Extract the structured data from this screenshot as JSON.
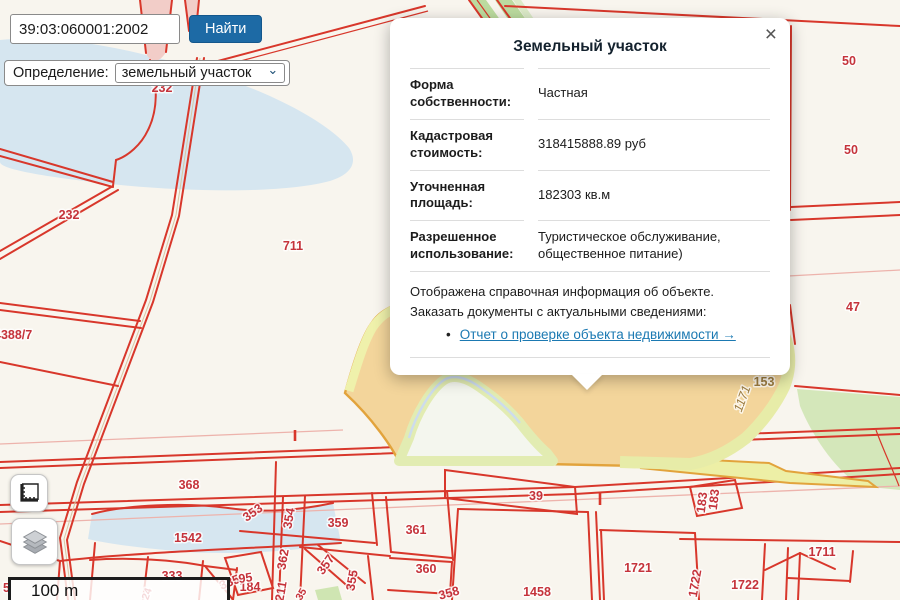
{
  "search": {
    "value": "39:03:060001:2002",
    "button_label": "Найти"
  },
  "filter": {
    "label": "Определение:",
    "selected": "земельный участок",
    "chevron": "⌄"
  },
  "popup": {
    "title": "Земельный участок",
    "close_label": "×",
    "bullet": "•",
    "rows": [
      {
        "label": "Форма собственности:",
        "value": "Частная"
      },
      {
        "label": "Кадастровая стоимость:",
        "value": "318415888.89 руб"
      },
      {
        "label": "Уточненная площадь:",
        "value": "182303 кв.м"
      },
      {
        "label": "Разрешенное использование:",
        "value": "Туристическое обслуживание, общественное питание)"
      }
    ],
    "note_line1": "Отображена справочная информация об объекте.",
    "note_line2": "Заказать документы с актуальными сведениями:",
    "link_label": "Отчет о проверке объекта недвижимости →"
  },
  "map": {
    "scale_label": "100 m",
    "labels": [
      {
        "text": "232",
        "x": 162,
        "y": 92
      },
      {
        "text": "232",
        "x": 69,
        "y": 219
      },
      {
        "text": "711",
        "x": 293,
        "y": 250
      },
      {
        "text": "4388/7",
        "x": -6,
        "y": 339,
        "cls": "start"
      },
      {
        "text": "50",
        "x": 849,
        "y": 65
      },
      {
        "text": "50",
        "x": 851,
        "y": 154
      },
      {
        "text": "47",
        "x": 853,
        "y": 311
      },
      {
        "text": "153",
        "x": 452,
        "y": 321,
        "cls": "brown"
      },
      {
        "text": "1171",
        "x": 540,
        "y": 328,
        "cls": "brown-italic"
      },
      {
        "text": "1171",
        "x": 746,
        "y": 400,
        "rot": -70,
        "cls": "brown-italic"
      },
      {
        "text": "153",
        "x": 764,
        "y": 386,
        "cls": "brown"
      },
      {
        "text": "368",
        "x": 189,
        "y": 489
      },
      {
        "text": "39",
        "x": 536,
        "y": 500
      },
      {
        "text": "1542",
        "x": 188,
        "y": 542
      },
      {
        "text": "353",
        "x": 255,
        "y": 516,
        "rot": -35
      },
      {
        "text": "354",
        "x": 293,
        "y": 519,
        "rot": -80
      },
      {
        "text": "359",
        "x": 338,
        "y": 527
      },
      {
        "text": "361",
        "x": 416,
        "y": 534
      },
      {
        "text": "360",
        "x": 426,
        "y": 573
      },
      {
        "text": "333",
        "x": 172,
        "y": 580
      },
      {
        "text": "335",
        "x": 231,
        "y": 586,
        "rot": -22
      },
      {
        "text": "184",
        "x": 250,
        "y": 591
      },
      {
        "text": "362",
        "x": 287,
        "y": 560,
        "rot": -80
      },
      {
        "text": "211",
        "x": 285,
        "y": 592,
        "rot": -80
      },
      {
        "text": "357",
        "x": 329,
        "y": 567,
        "rot": -55
      },
      {
        "text": "355",
        "x": 356,
        "y": 581,
        "rot": -80
      },
      {
        "text": "358",
        "x": 450,
        "y": 597,
        "rot": -15
      },
      {
        "text": "35",
        "x": 304,
        "y": 596,
        "rot": -60,
        "cls": "small"
      },
      {
        "text": "24",
        "x": 150,
        "y": 595,
        "rot": -70,
        "cls": "small"
      },
      {
        "text": "95",
        "x": 246,
        "y": 582,
        "rot": -8
      },
      {
        "text": "5",
        "x": 3,
        "y": 592,
        "cls": "start"
      },
      {
        "text": "1458",
        "x": 537,
        "y": 596
      },
      {
        "text": "1721",
        "x": 638,
        "y": 572
      },
      {
        "text": "1722",
        "x": 745,
        "y": 589
      },
      {
        "text": "1722",
        "x": 699,
        "y": 584,
        "rot": -80
      },
      {
        "text": "1711",
        "x": 822,
        "y": 556
      },
      {
        "text": "183",
        "x": 706,
        "y": 503,
        "rot": -83
      },
      {
        "text": "183",
        "x": 718,
        "y": 500,
        "rot": -83
      }
    ]
  },
  "icons": {
    "measure": "ruler-icon",
    "layers": "layers-icon",
    "close": "close-icon",
    "select": "chevron-down-icon"
  },
  "colors": {
    "accent_blue": "#1d6aa5",
    "link": "#1b79b2",
    "parcel_fill": "#f3d59b",
    "parcel_stroke": "#e2a33c",
    "red_line": "#d8372b",
    "label_red": "#c5333b",
    "water": "#d6e6f0",
    "green": "#cde3b0",
    "label_brown": "#9c7c40"
  }
}
